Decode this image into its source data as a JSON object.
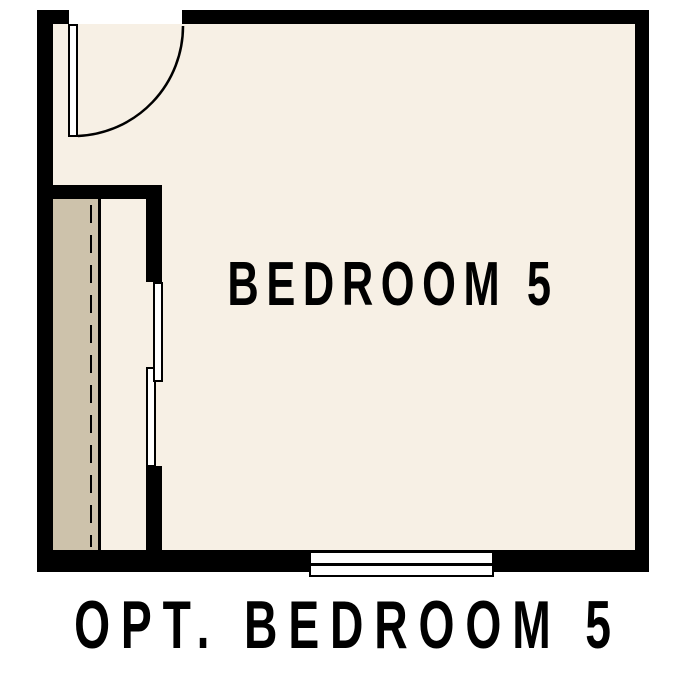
{
  "plan": {
    "room_label": "BEDROOM 5",
    "caption": "OPT. BEDROOM 5"
  },
  "colors": {
    "background": "#ffffff",
    "wall": "#000000",
    "floor": "#f7f0e5",
    "closet_shelf": "#cdc2ab",
    "fixture": "#ffffff",
    "text": "#000000"
  }
}
